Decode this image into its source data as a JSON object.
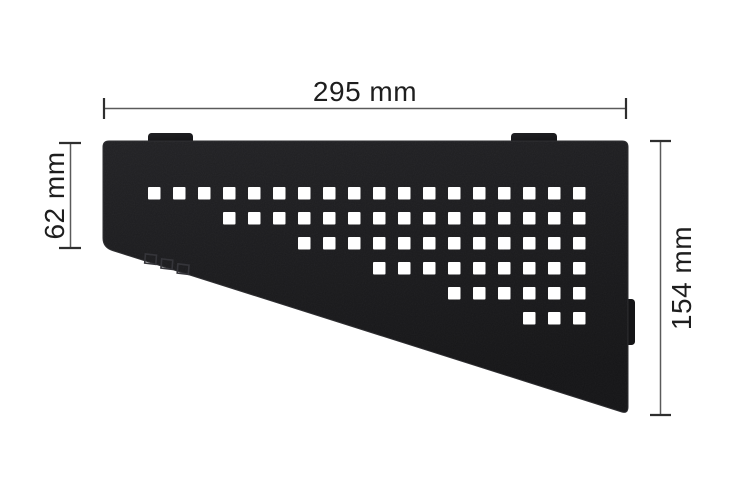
{
  "diagram": {
    "kind": "product-dimension-drawing",
    "subject": "quadrilateral corner shelf with square perforation pattern",
    "background": "#ffffff",
    "annotation": {
      "text_color": "#1e1e1e",
      "line_color": "#5a5a5a",
      "tick_color": "#2e2e2e"
    },
    "dimensions": {
      "width": {
        "label": "295 mm"
      },
      "left_height": {
        "label": "62 mm"
      },
      "right_height": {
        "label": "154 mm"
      }
    },
    "shelf": {
      "body_color_top": "#202023",
      "body_color_bottom": "#131315",
      "edge_color": "#2c2c2f",
      "perforation_color": "#ffffff",
      "logo": "schluter-mark",
      "mounting_tabs_top": 2,
      "side_tab_right": 1,
      "pattern": {
        "type": "square-grid-staircase",
        "origin_x": 148,
        "origin_y": 187,
        "pitch": 25,
        "square": 12.5,
        "total_columns": 18,
        "rows": [
          {
            "start_col": 0,
            "count": 18
          },
          {
            "start_col": 3,
            "count": 15
          },
          {
            "start_col": 6,
            "count": 12
          },
          {
            "start_col": 9,
            "count": 9
          },
          {
            "start_col": 12,
            "count": 6
          },
          {
            "start_col": 15,
            "count": 3
          }
        ]
      }
    }
  }
}
